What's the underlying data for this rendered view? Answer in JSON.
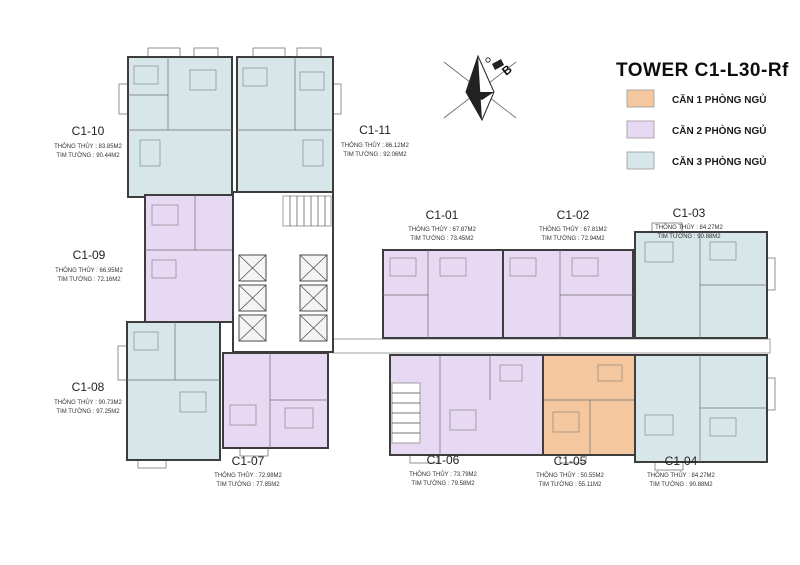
{
  "title": "TOWER C1-L30-Rf",
  "compass": {
    "label": "B"
  },
  "colors": {
    "one_br": "#f5c79e",
    "two_br": "#e7d8f3",
    "three_br": "#d7e6e9",
    "wall": "#3d3d3d"
  },
  "legend": {
    "items": [
      {
        "label": "CĂN 1 PHÒNG NGỦ",
        "color": "#f5c79e",
        "type": "1-bedroom"
      },
      {
        "label": "CĂN 2 PHÒNG NGỦ",
        "color": "#e7d8f3",
        "type": "2-bedroom"
      },
      {
        "label": "CĂN 3 PHÒNG NGỦ",
        "color": "#d7e6e9",
        "type": "3-bedroom"
      }
    ]
  },
  "area_labels": {
    "net": "THÔNG THỦY",
    "gross": "TIM TƯỜNG"
  },
  "units": [
    {
      "id": "C1-01",
      "bedrooms": 2,
      "net_area": "67.87M2",
      "gross_area": "73.45M2",
      "net_line": "THÔNG THỦY : 67.87M2",
      "gross_line": "TIM TƯỜNG : 73.45M2"
    },
    {
      "id": "C1-02",
      "bedrooms": 2,
      "net_area": "67.81M2",
      "gross_area": "72.94M2",
      "net_line": "THÔNG THỦY : 67.81M2",
      "gross_line": "TIM TƯỜNG : 72.94M2"
    },
    {
      "id": "C1-03",
      "bedrooms": 3,
      "net_area": "84.27M2",
      "gross_area": "90.88M2",
      "net_line": "THÔNG THỦY : 84.27M2",
      "gross_line": "TIM TƯỜNG : 90.88M2"
    },
    {
      "id": "C1-04",
      "bedrooms": 3,
      "net_area": "84.27M2",
      "gross_area": "90.88M2",
      "net_line": "THÔNG THỦY : 84.27M2",
      "gross_line": "TIM TƯỜNG : 90.88M2"
    },
    {
      "id": "C1-05",
      "bedrooms": 1,
      "net_area": "50.55M2",
      "gross_area": "55.11M2",
      "net_line": "THÔNG THỦY : 50.55M2",
      "gross_line": "TIM TƯỜNG : 55.11M2"
    },
    {
      "id": "C1-06",
      "bedrooms": 2,
      "net_area": "73.79M2",
      "gross_area": "79.58M2",
      "net_line": "THÔNG THỦY : 73.79M2",
      "gross_line": "TIM TƯỜNG : 79.58M2"
    },
    {
      "id": "C1-07",
      "bedrooms": 2,
      "net_area": "72.98M2",
      "gross_area": "77.85M2",
      "net_line": "THÔNG THỦY : 72.98M2",
      "gross_line": "TIM TƯỜNG : 77.85M2"
    },
    {
      "id": "C1-08",
      "bedrooms": 3,
      "net_area": "90.73M2",
      "gross_area": "97.25M2",
      "net_line": "THÔNG THỦY : 90.73M2",
      "gross_line": "TIM TƯỜNG : 97.25M2"
    },
    {
      "id": "C1-09",
      "bedrooms": 2,
      "net_area": "66.95M2",
      "gross_area": "72.16M2",
      "net_line": "THÔNG THỦY : 66.95M2",
      "gross_line": "TIM TƯỜNG : 72.16M2"
    },
    {
      "id": "C1-10",
      "bedrooms": 3,
      "net_area": "83.85M2",
      "gross_area": "90.44M2",
      "net_line": "THÔNG THỦY : 83.85M2",
      "gross_line": "TIM TƯỜNG : 90.44M2"
    },
    {
      "id": "C1-11",
      "bedrooms": 3,
      "net_area": "86.12M2",
      "gross_area": "92.06M2",
      "net_line": "THÔNG THỦY : 86.12M2",
      "gross_line": "TIM TƯỜNG : 92.06M2"
    }
  ]
}
